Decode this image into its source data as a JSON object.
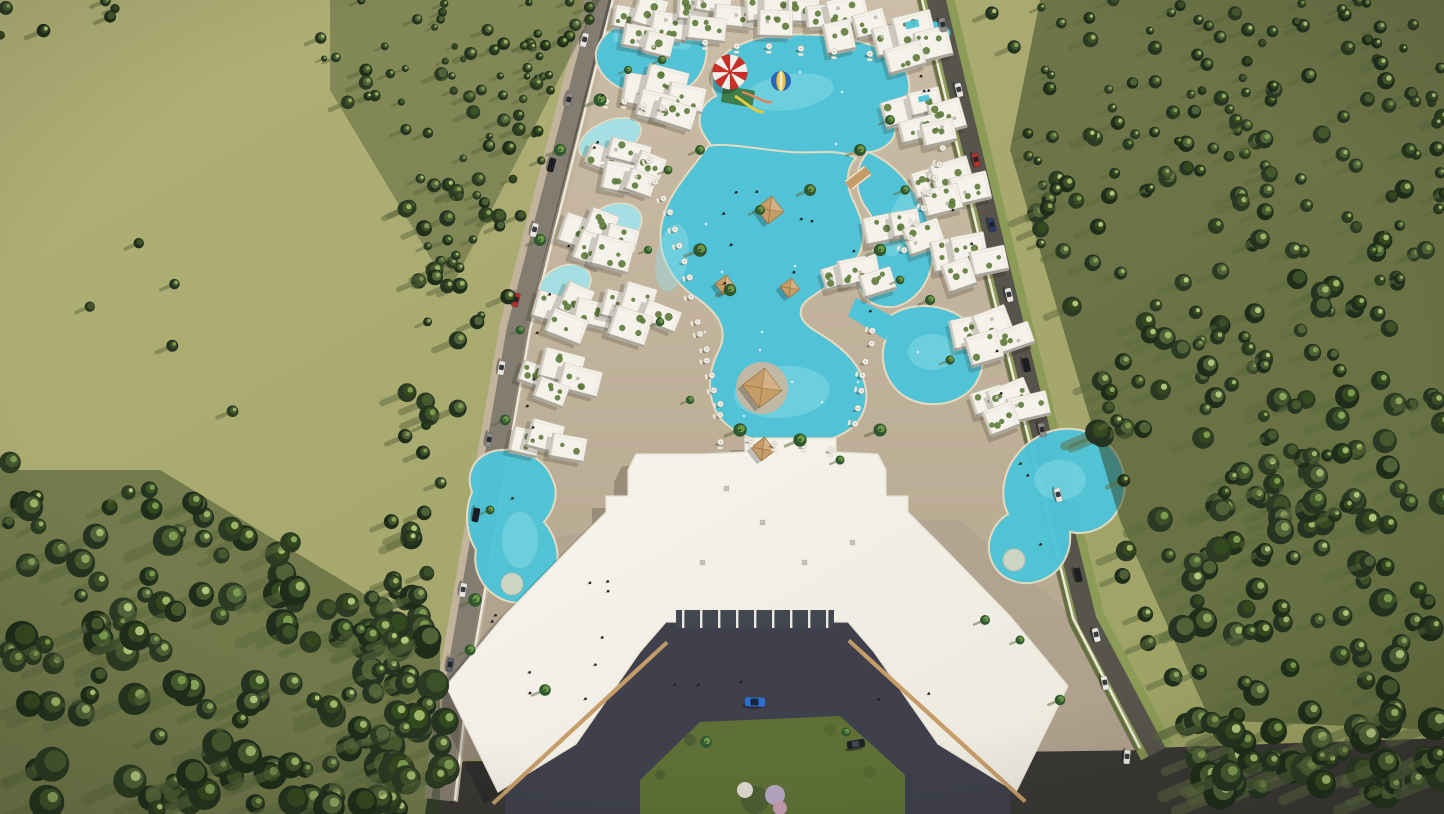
{
  "meta": {
    "description": "Aerial 3D architectural rendering of a gated resort compound: white low-rise apartment blocks with planted roof terraces arranged in a zigzag around a meandering turquoise lagoon pool, a children's water playground with a red-and-white checkered canopy and a blue-and-yellow striped ball float, timber pyramid-roof cabanas, white sun umbrellas, a large U-shaped clubhouse with timber pergola wings and an entrance courtyard, perimeter roads with parked cars, an open olive grass field to the west and dense pine forest to the east, late afternoon sun casting long shadows to the south-west."
  },
  "scene": {
    "setting": "aerial perspective, late afternoon light, long shadows toward south-west",
    "areas": [
      "open grass field (west)",
      "dense pine forest (east and south-west corner)",
      "resort grounds with tan paved promenades",
      "meandering turquoise lagoon pools with sandy edges",
      "children's water playground with checkered canopy and striped ball",
      "white apartment blocks with roof gardens",
      "timber pool cabanas and white umbrellas with loungers",
      "U-shaped clubhouse with pergola wings",
      "entrance courtyard with lawn island and flowering shrubs",
      "perimeter roads with parked and moving cars",
      "south boundary road"
    ],
    "object_counts": {
      "pool_cabanas": 5,
      "round_island_pools": 2,
      "courtyard_cars": 2
    }
  },
  "palette": {
    "field": "#a6a76d",
    "field_light": "#b2b278",
    "field_dark": "#99a061",
    "grass_strip": "#8a9a53",
    "forest_base": "#31401f",
    "forest_darks": [
      "#243420",
      "#2b3a22",
      "#1f2e1b"
    ],
    "forest_mids": [
      "#3d5128",
      "#46592e",
      "#35491f",
      "#4f6238"
    ],
    "forest_lights": [
      "#8aa45c",
      "#9cb468",
      "#7c9a4e",
      "#b2c47c"
    ],
    "tree_shadow": "#5d6a3e",
    "pavement": "#c7b7a0",
    "pavement_dark": "#b1a28b",
    "plaza": "#a99c8c",
    "building_white": "#f5f2eb",
    "building_edge": "#d7d1c4",
    "roof_green": "#5d7a3b",
    "pool": "#4fc4d8",
    "pool_light": "#93e0ea",
    "pool_pale": "#a5dfe3",
    "sand_edge": "#e7dcc2",
    "road_left": "#837c71",
    "road_right": "#57544b",
    "road_bottom": "#3a3835",
    "wall_white": "#efe9dc",
    "asphalt_court": "#3f404b",
    "lawn": "#5e7036",
    "wood": "#c69d68",
    "wood_dark": "#9a7443",
    "canopy_red": "#cc2f28",
    "canopy_white": "#f2efe8",
    "ball_blue": "#2e64b5",
    "ball_yellow": "#e4c93f",
    "glazing": "#434850",
    "car_blue": "#2f6fd2",
    "car_black": "#1e1f24",
    "car_white": "#e8e6e0",
    "car_red": "#b3312d",
    "car_gray": "#8b8a86",
    "umbrella": "#f1eee6",
    "people": "#26241f",
    "swimmer": "#e8f4f4",
    "palm_dark": "#2f5830",
    "palm_light": "#6d9747"
  }
}
